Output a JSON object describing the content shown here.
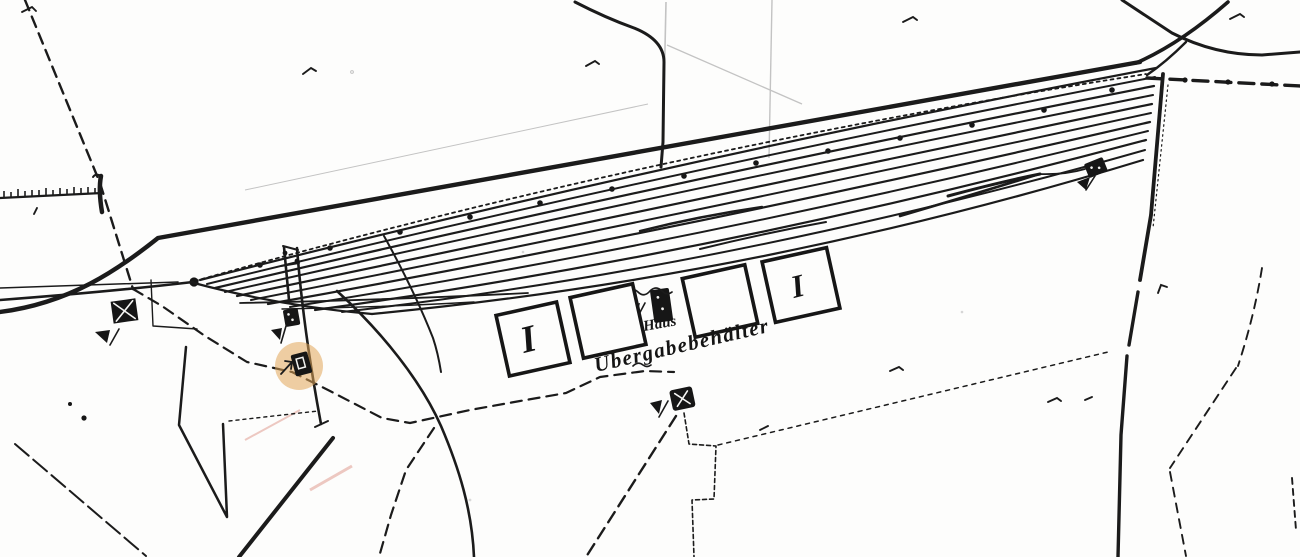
{
  "map": {
    "kind": "scanned-historical-railway-track-plan",
    "labels": {
      "haus": "Haus",
      "uebergabebehaelter": "Übergabebehälter",
      "building1_mark": "I",
      "building4_mark": "I"
    },
    "colors": {
      "ink": "#1b1b1b",
      "paper": "#fdfdfc",
      "highlight": "#e2a558",
      "faint": "#c3c3c3"
    },
    "highlight_marker": {
      "shape": "circle",
      "opacity": "0.55"
    },
    "symbols": [
      "signal-box-with-cross",
      "pennant-flag",
      "siding-stub-box",
      "highlighted-click-box",
      "haus-building-block",
      "boundary-stone-box",
      "yard-end-box"
    ]
  }
}
